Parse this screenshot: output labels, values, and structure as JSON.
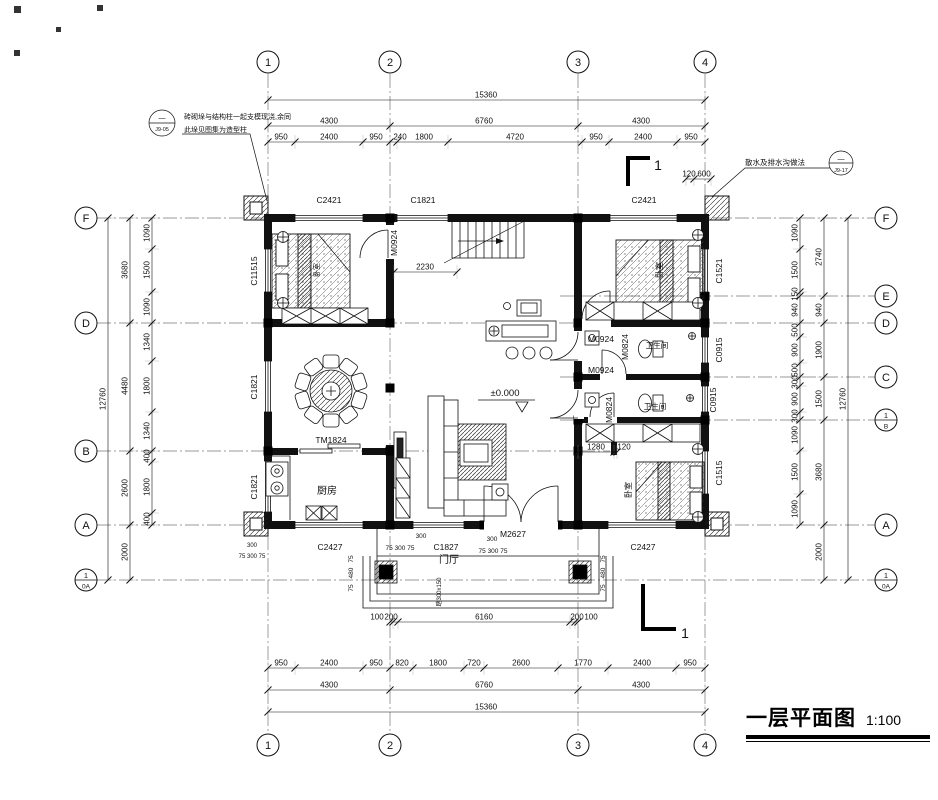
{
  "meta": {
    "title": "一层平面图",
    "scale": "1:100"
  },
  "axis_bubbles": [
    {
      "x": 268,
      "y": 62,
      "t": "1"
    },
    {
      "x": 390,
      "y": 62,
      "t": "2"
    },
    {
      "x": 578,
      "y": 62,
      "t": "3"
    },
    {
      "x": 705,
      "y": 62,
      "t": "4"
    },
    {
      "x": 268,
      "y": 745,
      "t": "1"
    },
    {
      "x": 390,
      "y": 745,
      "t": "2"
    },
    {
      "x": 578,
      "y": 745,
      "t": "3"
    },
    {
      "x": 705,
      "y": 745,
      "t": "4"
    },
    {
      "x": 86,
      "y": 218,
      "t": "F"
    },
    {
      "x": 86,
      "y": 323,
      "t": "D"
    },
    {
      "x": 86,
      "y": 451,
      "t": "B"
    },
    {
      "x": 86,
      "y": 525,
      "t": "A"
    },
    {
      "x": 86,
      "y": 580,
      "top": "1",
      "bottom": "0A"
    },
    {
      "x": 886,
      "y": 218,
      "t": "F"
    },
    {
      "x": 886,
      "y": 296,
      "t": "E"
    },
    {
      "x": 886,
      "y": 323,
      "t": "D"
    },
    {
      "x": 886,
      "y": 377,
      "t": "C"
    },
    {
      "x": 886,
      "y": 420,
      "top": "1",
      "bottom": "B"
    },
    {
      "x": 886,
      "y": 525,
      "t": "A"
    },
    {
      "x": 886,
      "y": 580,
      "top": "1",
      "bottom": "0A"
    }
  ],
  "dim_chains": [
    {
      "o": "h",
      "p": 100,
      "t": [
        268,
        705
      ],
      "l": [
        {
          "t": "15360",
          "x": 486
        }
      ]
    },
    {
      "o": "h",
      "p": 126,
      "t": [
        268,
        390,
        578,
        705
      ],
      "l": [
        {
          "t": "4300",
          "x": 329
        },
        {
          "t": "6760",
          "x": 484
        },
        {
          "t": "4300",
          "x": 641
        }
      ]
    },
    {
      "o": "h",
      "p": 142,
      "t": [
        268,
        295,
        363,
        390,
        397,
        448,
        582,
        609,
        677,
        705
      ],
      "l": [
        {
          "t": "950",
          "x": 281
        },
        {
          "t": "2400",
          "x": 329
        },
        {
          "t": "950",
          "x": 376
        },
        {
          "t": "240",
          "x": 400
        },
        {
          "t": "1800",
          "x": 424
        },
        {
          "t": "4720",
          "x": 515
        },
        {
          "t": "950",
          "x": 596
        },
        {
          "t": "2400",
          "x": 643
        },
        {
          "t": "950",
          "x": 691
        }
      ]
    },
    {
      "o": "h",
      "p": 622,
      "t": [
        390,
        393,
        398,
        570,
        575,
        578
      ],
      "l": [
        {
          "t": "100",
          "x": 377
        },
        {
          "t": "200",
          "x": 391
        },
        {
          "t": "6160",
          "x": 484
        },
        {
          "t": "200",
          "x": 577
        },
        {
          "t": "100",
          "x": 591
        }
      ]
    },
    {
      "o": "h",
      "p": 668,
      "t": [
        268,
        295,
        363,
        390,
        413,
        464,
        484,
        558,
        608,
        676,
        705
      ],
      "l": [
        {
          "t": "950",
          "x": 281
        },
        {
          "t": "2400",
          "x": 329
        },
        {
          "t": "950",
          "x": 376
        },
        {
          "t": "820",
          "x": 402
        },
        {
          "t": "1800",
          "x": 438
        },
        {
          "t": "720",
          "x": 474
        },
        {
          "t": "2600",
          "x": 521
        },
        {
          "t": "1770",
          "x": 583
        },
        {
          "t": "2400",
          "x": 642
        },
        {
          "t": "950",
          "x": 690
        }
      ]
    },
    {
      "o": "h",
      "p": 690,
      "t": [
        268,
        390,
        578,
        705
      ],
      "l": [
        {
          "t": "4300",
          "x": 329
        },
        {
          "t": "6760",
          "x": 484
        },
        {
          "t": "4300",
          "x": 641
        }
      ]
    },
    {
      "o": "h",
      "p": 712,
      "t": [
        268,
        705
      ],
      "l": [
        {
          "t": "15360",
          "x": 486
        }
      ]
    },
    {
      "o": "h",
      "p": 272,
      "t": [
        394,
        457
      ],
      "l": [
        {
          "t": "2230",
          "x": 425
        }
      ]
    },
    {
      "o": "h",
      "p": 452,
      "t": [
        578,
        614,
        617
      ],
      "l": [
        {
          "t": "1280",
          "x": 596
        },
        {
          "t": "120",
          "x": 624
        }
      ]
    },
    {
      "o": "h",
      "p": 179,
      "t": [
        686,
        694,
        711
      ],
      "l": [
        {
          "t": "120",
          "x": 689
        },
        {
          "t": "600",
          "x": 704
        }
      ]
    },
    {
      "o": "v",
      "p": 108,
      "t": [
        218,
        580
      ],
      "l": [
        {
          "t": "12760",
          "y": 399
        }
      ]
    },
    {
      "o": "v",
      "p": 130,
      "t": [
        218,
        323,
        451,
        525,
        580
      ],
      "l": [
        {
          "t": "3680",
          "y": 270
        },
        {
          "t": "4480",
          "y": 386
        },
        {
          "t": "2600",
          "y": 488
        },
        {
          "t": "2000",
          "y": 552
        }
      ]
    },
    {
      "o": "v",
      "p": 152,
      "t": [
        218,
        249,
        292,
        323,
        361,
        412,
        451,
        462,
        513,
        525
      ],
      "l": [
        {
          "t": "1090",
          "y": 233
        },
        {
          "t": "1500",
          "y": 270
        },
        {
          "t": "1090",
          "y": 307
        },
        {
          "t": "1340",
          "y": 342
        },
        {
          "t": "1800",
          "y": 386
        },
        {
          "t": "1340",
          "y": 431
        },
        {
          "t": "400",
          "y": 456
        },
        {
          "t": "1800",
          "y": 487
        },
        {
          "t": "400",
          "y": 519
        }
      ]
    },
    {
      "o": "v",
      "p": 800,
      "t": [
        218,
        249,
        292,
        296,
        323,
        337,
        363,
        377,
        386,
        412,
        420,
        451,
        494,
        525
      ],
      "l": [
        {
          "t": "1090",
          "y": 233
        },
        {
          "t": "1500",
          "y": 270
        },
        {
          "t": "150",
          "y": 294
        },
        {
          "t": "940",
          "y": 310
        },
        {
          "t": "500",
          "y": 330
        },
        {
          "t": "900",
          "y": 350
        },
        {
          "t": "500",
          "y": 370
        },
        {
          "t": "300",
          "y": 382
        },
        {
          "t": "900",
          "y": 399
        },
        {
          "t": "300",
          "y": 416
        },
        {
          "t": "1090",
          "y": 435
        },
        {
          "t": "1500",
          "y": 472
        },
        {
          "t": "1090",
          "y": 509
        }
      ]
    },
    {
      "o": "v",
      "p": 824,
      "t": [
        218,
        296,
        323,
        377,
        420,
        525,
        580
      ],
      "l": [
        {
          "t": "2740",
          "y": 257
        },
        {
          "t": "940",
          "y": 310
        },
        {
          "t": "1900",
          "y": 350
        },
        {
          "t": "1500",
          "y": 399
        },
        {
          "t": "3680",
          "y": 472
        },
        {
          "t": "2000",
          "y": 552
        }
      ]
    },
    {
      "o": "v",
      "p": 848,
      "t": [
        218,
        580
      ],
      "l": [
        {
          "t": "12760",
          "y": 399
        }
      ]
    }
  ],
  "free_labels": [
    {
      "t": "C2421",
      "x": 329,
      "y": 203,
      "n": "window-label"
    },
    {
      "t": "C1821",
      "x": 423,
      "y": 203,
      "n": "window-label"
    },
    {
      "t": "C2421",
      "x": 644,
      "y": 203,
      "n": "window-label"
    },
    {
      "t": "C11515",
      "x": 257,
      "y": 271,
      "v": 1,
      "n": "window-label"
    },
    {
      "t": "C1821",
      "x": 257,
      "y": 387,
      "v": 1,
      "n": "window-label"
    },
    {
      "t": "C1821",
      "x": 257,
      "y": 487,
      "v": 1,
      "n": "window-label"
    },
    {
      "t": "C1521",
      "x": 722,
      "y": 271,
      "v": 1,
      "n": "window-label"
    },
    {
      "t": "C0915",
      "x": 722,
      "y": 350,
      "v": 1,
      "n": "window-label"
    },
    {
      "t": "C0915",
      "x": 716,
      "y": 400,
      "v": 1,
      "n": "window-label"
    },
    {
      "t": "C1515",
      "x": 722,
      "y": 473,
      "v": 1,
      "n": "window-label"
    },
    {
      "t": "C2427",
      "x": 330,
      "y": 550,
      "n": "window-label"
    },
    {
      "t": "C1827",
      "x": 446,
      "y": 550,
      "n": "window-label"
    },
    {
      "t": "M2627",
      "x": 513,
      "y": 537,
      "n": "door-label"
    },
    {
      "t": "C2427",
      "x": 643,
      "y": 550,
      "n": "window-label"
    },
    {
      "t": "M0924",
      "x": 397,
      "y": 243,
      "v": 1,
      "n": "door-label"
    },
    {
      "t": "M0924",
      "x": 601,
      "y": 342,
      "n": "door-label"
    },
    {
      "t": "M0924",
      "x": 601,
      "y": 373,
      "n": "door-label"
    },
    {
      "t": "M0824",
      "x": 628,
      "y": 347,
      "v": 1,
      "n": "door-label"
    },
    {
      "t": "M0824",
      "x": 612,
      "y": 410,
      "v": 1,
      "n": "door-label"
    },
    {
      "t": "TM1824",
      "x": 331,
      "y": 443,
      "n": "door-label"
    },
    {
      "t": "厨房",
      "x": 327,
      "y": 494,
      "s": 10,
      "n": "room-label"
    },
    {
      "t": "门厅",
      "x": 449,
      "y": 563,
      "s": 10,
      "n": "room-label"
    },
    {
      "t": "卫生间",
      "x": 657,
      "y": 348,
      "s": 7.5,
      "n": "room-label"
    },
    {
      "t": "卫生间",
      "x": 655,
      "y": 409,
      "s": 7.5,
      "n": "room-label"
    },
    {
      "t": "卧室",
      "x": 662,
      "y": 270,
      "v": 1,
      "s": 8,
      "n": "room-label"
    },
    {
      "t": "卧室",
      "x": 631,
      "y": 490,
      "v": 1,
      "s": 8,
      "n": "room-label"
    },
    {
      "t": "卧室",
      "x": 319,
      "y": 270,
      "v": 1,
      "s": 7,
      "n": "room-label"
    },
    {
      "t": "±0.000",
      "x": 505,
      "y": 396,
      "s": 9.5,
      "n": "level-mark"
    },
    {
      "t": "300",
      "x": 421,
      "y": 538,
      "s": 6.5,
      "n": "dim-label"
    },
    {
      "t": "75 300 75",
      "x": 400,
      "y": 550,
      "s": 6.5,
      "n": "dim-label"
    },
    {
      "t": "300",
      "x": 492,
      "y": 541,
      "s": 6.5,
      "n": "dim-label"
    },
    {
      "t": "75 300 75",
      "x": 493,
      "y": 553,
      "s": 6.5,
      "n": "dim-label"
    },
    {
      "t": "300",
      "x": 252,
      "y": 547,
      "s": 6,
      "n": "dim-label"
    },
    {
      "t": "75 300 75",
      "x": 252,
      "y": 558,
      "s": 6,
      "n": "dim-label"
    },
    {
      "t": "75",
      "x": 353,
      "y": 559,
      "v": 1,
      "s": 6.5,
      "n": "dim-label"
    },
    {
      "t": "480",
      "x": 353,
      "y": 573,
      "v": 1,
      "s": 6.5,
      "n": "dim-label"
    },
    {
      "t": "75",
      "x": 353,
      "y": 588,
      "v": 1,
      "s": 6.5,
      "n": "dim-label"
    },
    {
      "t": "75",
      "x": 605,
      "y": 559,
      "v": 1,
      "s": 6.5,
      "n": "dim-label"
    },
    {
      "t": "480",
      "x": 605,
      "y": 573,
      "v": 1,
      "s": 6.5,
      "n": "dim-label"
    },
    {
      "t": "75",
      "x": 605,
      "y": 588,
      "v": 1,
      "s": 6.5,
      "n": "dim-label"
    },
    {
      "t": "踏300x150",
      "x": 441,
      "y": 592,
      "v": 1,
      "s": 6,
      "n": "steps-note"
    },
    {
      "t": "1",
      "x": 658,
      "y": 170,
      "s": 14,
      "n": "section-number"
    },
    {
      "t": "1",
      "x": 685,
      "y": 638,
      "s": 14,
      "n": "section-number"
    },
    {
      "t": "砖砌垛与结构柱一起支模现浇,余同",
      "x": 184,
      "y": 119,
      "a": "start",
      "s": 7,
      "n": "note-text"
    },
    {
      "t": "此垛见图集为造型柱",
      "x": 184,
      "y": 132,
      "a": "start",
      "s": 7,
      "n": "note-text"
    },
    {
      "t": "—",
      "x": 162,
      "y": 120,
      "s": 7,
      "n": "ref-bubble-top"
    },
    {
      "t": "J9-05",
      "x": 162,
      "y": 131,
      "s": 5.5,
      "n": "ref-bubble-code"
    },
    {
      "t": "散水及排水沟做法",
      "x": 745,
      "y": 165,
      "a": "start",
      "s": 7.5,
      "n": "note-text"
    },
    {
      "t": "—",
      "x": 841,
      "y": 161,
      "s": 7,
      "n": "ref-bubble-top"
    },
    {
      "t": "J9-17",
      "x": 841,
      "y": 172,
      "s": 5.5,
      "n": "ref-bubble-code"
    }
  ]
}
